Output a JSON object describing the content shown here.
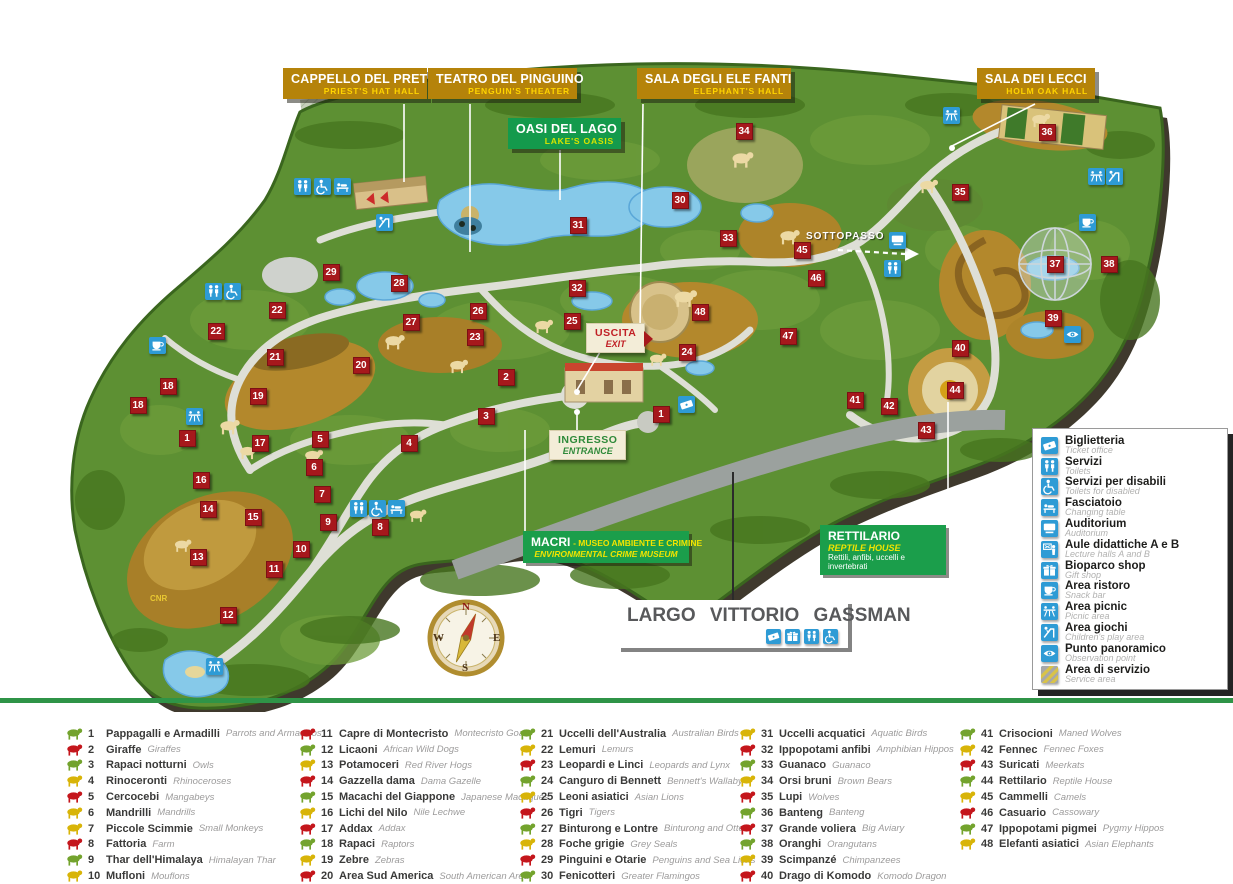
{
  "map": {
    "hall_labels": [
      {
        "id": "cappello-del-prete",
        "title": "CAPPELLO DEL PRETE",
        "subtitle": "PRIEST'S HAT HALL",
        "style": "gold",
        "x": 283,
        "y": 68,
        "w": 144
      },
      {
        "id": "teatro-del-pinguino",
        "title": "TEATRO DEL PINGUINO",
        "subtitle": "PENGUIN'S THEATER",
        "style": "gold",
        "x": 428,
        "y": 68,
        "w": 149
      },
      {
        "id": "oasi-del-lago",
        "title": "OASI DEL LAGO",
        "subtitle": "LAKE'S OASIS",
        "style": "green",
        "x": 508,
        "y": 118,
        "w": 113
      },
      {
        "id": "sala-degli-elefanti",
        "title": "SALA DEGLI ELE FANTI",
        "subtitle": "ELEPHANT'S HALL",
        "style": "gold",
        "x": 637,
        "y": 68,
        "w": 154
      },
      {
        "id": "sala-dei-lecci",
        "title": "SALA DEI LECCI",
        "subtitle": "HOLM OAK HALL",
        "style": "gold",
        "x": 977,
        "y": 68,
        "w": 118
      }
    ],
    "special": {
      "uscita": {
        "title": "USCITA",
        "subtitle": "EXIT"
      },
      "ingresso": {
        "title": "INGRESSO",
        "subtitle": "ENTRANCE"
      },
      "macri": {
        "title": "MACRI",
        "subtitle": "-  MUSEO AMBIENTE  E CRIMINE",
        "subtitle2": "ENVIRONMENTAL CRIME MUSEUM"
      },
      "rettilario": {
        "title": "RETTILARIO",
        "subtitle": "REPTILE HOUSE",
        "desc": "Rettili, anfibi, uccelli e invertebrati"
      },
      "largo": {
        "title": "LARGO VITTORIO GASSMAN",
        "icons": [
          "ticket",
          "shop",
          "toilets",
          "disabled"
        ]
      },
      "sottopasso": {
        "text": "SOTTOPASSO"
      },
      "cnr": {
        "text": "CNR"
      }
    },
    "compass": {
      "n": "N",
      "e": "E",
      "s": "S",
      "w": "W"
    },
    "markers": [
      {
        "n": "1",
        "x": 187,
        "y": 438
      },
      {
        "n": "16",
        "x": 201,
        "y": 480
      },
      {
        "n": "18",
        "x": 138,
        "y": 405
      },
      {
        "n": "18",
        "x": 168,
        "y": 386
      },
      {
        "n": "13",
        "x": 198,
        "y": 557
      },
      {
        "n": "14",
        "x": 208,
        "y": 509
      },
      {
        "n": "12",
        "x": 228,
        "y": 615
      },
      {
        "n": "15",
        "x": 253,
        "y": 517
      },
      {
        "n": "11",
        "x": 274,
        "y": 569
      },
      {
        "n": "10",
        "x": 301,
        "y": 549
      },
      {
        "n": "9",
        "x": 328,
        "y": 522
      },
      {
        "n": "8",
        "x": 380,
        "y": 527
      },
      {
        "n": "7",
        "x": 322,
        "y": 494
      },
      {
        "n": "6",
        "x": 314,
        "y": 467
      },
      {
        "n": "5",
        "x": 320,
        "y": 439
      },
      {
        "n": "17",
        "x": 260,
        "y": 443
      },
      {
        "n": "4",
        "x": 409,
        "y": 443
      },
      {
        "n": "19",
        "x": 258,
        "y": 396
      },
      {
        "n": "20",
        "x": 361,
        "y": 365
      },
      {
        "n": "21",
        "x": 275,
        "y": 357
      },
      {
        "n": "22",
        "x": 216,
        "y": 331
      },
      {
        "n": "22",
        "x": 277,
        "y": 310
      },
      {
        "n": "29",
        "x": 331,
        "y": 272
      },
      {
        "n": "28",
        "x": 399,
        "y": 283
      },
      {
        "n": "27",
        "x": 411,
        "y": 322
      },
      {
        "n": "26",
        "x": 478,
        "y": 311
      },
      {
        "n": "23",
        "x": 475,
        "y": 337
      },
      {
        "n": "25",
        "x": 572,
        "y": 321
      },
      {
        "n": "24",
        "x": 687,
        "y": 352
      },
      {
        "n": "2",
        "x": 506,
        "y": 377
      },
      {
        "n": "3",
        "x": 486,
        "y": 416
      },
      {
        "n": "1",
        "x": 661,
        "y": 414
      },
      {
        "n": "31",
        "x": 578,
        "y": 225
      },
      {
        "n": "32",
        "x": 577,
        "y": 288
      },
      {
        "n": "30",
        "x": 680,
        "y": 200
      },
      {
        "n": "34",
        "x": 744,
        "y": 131
      },
      {
        "n": "33",
        "x": 728,
        "y": 238
      },
      {
        "n": "45",
        "x": 802,
        "y": 250
      },
      {
        "n": "46",
        "x": 816,
        "y": 278
      },
      {
        "n": "48",
        "x": 700,
        "y": 312
      },
      {
        "n": "47",
        "x": 788,
        "y": 336
      },
      {
        "n": "35",
        "x": 960,
        "y": 192
      },
      {
        "n": "36",
        "x": 1047,
        "y": 132
      },
      {
        "n": "37",
        "x": 1055,
        "y": 264
      },
      {
        "n": "38",
        "x": 1109,
        "y": 264
      },
      {
        "n": "39",
        "x": 1053,
        "y": 318
      },
      {
        "n": "40",
        "x": 960,
        "y": 348
      },
      {
        "n": "44",
        "x": 955,
        "y": 390
      },
      {
        "n": "41",
        "x": 855,
        "y": 400
      },
      {
        "n": "42",
        "x": 889,
        "y": 406
      },
      {
        "n": "43",
        "x": 926,
        "y": 430
      }
    ],
    "facility_icons": [
      {
        "icon": "toilets",
        "x": 302,
        "y": 186
      },
      {
        "icon": "disabled",
        "x": 322,
        "y": 186
      },
      {
        "icon": "changing",
        "x": 342,
        "y": 186
      },
      {
        "icon": "playground",
        "x": 384,
        "y": 222
      },
      {
        "icon": "toilets",
        "x": 213,
        "y": 291
      },
      {
        "icon": "disabled",
        "x": 232,
        "y": 291
      },
      {
        "icon": "restaurant",
        "x": 157,
        "y": 345
      },
      {
        "icon": "picnic",
        "x": 194,
        "y": 416
      },
      {
        "icon": "toilets",
        "x": 358,
        "y": 508
      },
      {
        "icon": "disabled",
        "x": 377,
        "y": 508
      },
      {
        "icon": "changing",
        "x": 396,
        "y": 508
      },
      {
        "icon": "picnic",
        "x": 214,
        "y": 666
      },
      {
        "icon": "ticket",
        "x": 686,
        "y": 404
      },
      {
        "icon": "auditorium",
        "x": 897,
        "y": 240
      },
      {
        "icon": "toilets",
        "x": 892,
        "y": 268
      },
      {
        "icon": "picnic",
        "x": 951,
        "y": 115
      },
      {
        "icon": "picnic",
        "x": 1096,
        "y": 176
      },
      {
        "icon": "playground",
        "x": 1114,
        "y": 176
      },
      {
        "icon": "restaurant",
        "x": 1087,
        "y": 222
      },
      {
        "icon": "panoramic",
        "x": 1072,
        "y": 334
      }
    ]
  },
  "legend_panel": {
    "items": [
      {
        "icon": "ticket",
        "name": "Biglietteria",
        "en": "Ticket office"
      },
      {
        "icon": "toilets",
        "name": "Servizi",
        "en": "Toilets"
      },
      {
        "icon": "disabled",
        "name": "Servizi per disabili",
        "en": "Toilets for disabled"
      },
      {
        "icon": "changing",
        "name": "Fasciatoio",
        "en": "Changing table"
      },
      {
        "icon": "auditorium",
        "name": "Auditorium",
        "en": "Auditorium"
      },
      {
        "icon": "lecture",
        "name": "Aule didattiche A e B",
        "en": "Lecture halls A and B"
      },
      {
        "icon": "shop",
        "name": "Bioparco shop",
        "en": "Gift shop"
      },
      {
        "icon": "restaurant",
        "name": "Area ristoro",
        "en": "Snack bar"
      },
      {
        "icon": "picnic",
        "name": "Area picnic",
        "en": "Picnic area"
      },
      {
        "icon": "playground",
        "name": "Area giochi",
        "en": "Children's play area"
      },
      {
        "icon": "panoramic",
        "name": "Punto panoramico",
        "en": "Observation point"
      },
      {
        "icon": "service",
        "name": "Area di servizio",
        "en": "Service area"
      }
    ]
  },
  "animal_legend": {
    "palette": {
      "red": "#c4161c",
      "green": "#73a32d",
      "yellow": "#d8b408"
    },
    "col_x": [
      64,
      297,
      517,
      737,
      957
    ],
    "columns": [
      [
        {
          "n": "1",
          "it": "Pappagalli e Armadilli",
          "en": "Parrots and Armadillos",
          "c": "green"
        },
        {
          "n": "2",
          "it": "Giraffe",
          "en": "Giraffes",
          "c": "red"
        },
        {
          "n": "3",
          "it": "Rapaci notturni",
          "en": "Owls",
          "c": "green"
        },
        {
          "n": "4",
          "it": "Rinoceronti",
          "en": "Rhinoceroses",
          "c": "yellow"
        },
        {
          "n": "5",
          "it": "Cercocebi",
          "en": "Mangabeys",
          "c": "red"
        },
        {
          "n": "6",
          "it": "Mandrilli",
          "en": "Mandrills",
          "c": "yellow"
        },
        {
          "n": "7",
          "it": "Piccole Scimmie",
          "en": "Small Monkeys",
          "c": "yellow"
        },
        {
          "n": "8",
          "it": "Fattoria",
          "en": "Farm",
          "c": "red"
        },
        {
          "n": "9",
          "it": "Thar dell'Himalaya",
          "en": "Himalayan Thar",
          "c": "green"
        },
        {
          "n": "10",
          "it": "Mufloni",
          "en": "Mouflons",
          "c": "yellow"
        }
      ],
      [
        {
          "n": "11",
          "it": "Capre di Montecristo",
          "en": "Montecristo Goats",
          "c": "red"
        },
        {
          "n": "12",
          "it": "Licaoni",
          "en": "African Wild Dogs",
          "c": "green"
        },
        {
          "n": "13",
          "it": "Potamoceri",
          "en": "Red River Hogs",
          "c": "yellow"
        },
        {
          "n": "14",
          "it": "Gazzella dama",
          "en": "Dama Gazelle",
          "c": "red"
        },
        {
          "n": "15",
          "it": "Macachi del Giappone",
          "en": "Japanese Macaques",
          "c": "green"
        },
        {
          "n": "16",
          "it": "Lichi del Nilo",
          "en": "Nile Lechwe",
          "c": "yellow"
        },
        {
          "n": "17",
          "it": "Addax",
          "en": "Addax",
          "c": "red"
        },
        {
          "n": "18",
          "it": "Rapaci",
          "en": "Raptors",
          "c": "green"
        },
        {
          "n": "19",
          "it": "Zebre",
          "en": "Zebras",
          "c": "yellow"
        },
        {
          "n": "20",
          "it": "Area Sud America",
          "en": "South American Area",
          "c": "red"
        }
      ],
      [
        {
          "n": "21",
          "it": "Uccelli dell'Australia",
          "en": "Australian Birds",
          "c": "green"
        },
        {
          "n": "22",
          "it": "Lemuri",
          "en": "Lemurs",
          "c": "yellow"
        },
        {
          "n": "23",
          "it": "Leopardi e Linci",
          "en": "Leopards and Lynx",
          "c": "red"
        },
        {
          "n": "24",
          "it": "Canguro di Bennett",
          "en": "Bennett's Wallaby",
          "c": "green"
        },
        {
          "n": "25",
          "it": "Leoni asiatici",
          "en": "Asian Lions",
          "c": "yellow"
        },
        {
          "n": "26",
          "it": "Tigri",
          "en": "Tigers",
          "c": "red"
        },
        {
          "n": "27",
          "it": "Binturong e Lontre",
          "en": "Binturong and Otters",
          "c": "green"
        },
        {
          "n": "28",
          "it": "Foche grigie",
          "en": "Grey Seals",
          "c": "yellow"
        },
        {
          "n": "29",
          "it": "Pinguini e Otarie",
          "en": "Penguins and Sea Lions",
          "c": "red"
        },
        {
          "n": "30",
          "it": "Fenicotteri",
          "en": "Greater Flamingos",
          "c": "green"
        }
      ],
      [
        {
          "n": "31",
          "it": "Uccelli acquatici",
          "en": "Aquatic Birds",
          "c": "yellow"
        },
        {
          "n": "32",
          "it": "Ippopotami anfibi",
          "en": "Amphibian Hippos",
          "c": "red"
        },
        {
          "n": "33",
          "it": "Guanaco",
          "en": "Guanaco",
          "c": "green"
        },
        {
          "n": "34",
          "it": "Orsi bruni",
          "en": "Brown Bears",
          "c": "yellow"
        },
        {
          "n": "35",
          "it": "Lupi",
          "en": "Wolves",
          "c": "red"
        },
        {
          "n": "36",
          "it": "Banteng",
          "en": "Banteng",
          "c": "green"
        },
        {
          "n": "37",
          "it": "Grande voliera",
          "en": "Big Aviary",
          "c": "red"
        },
        {
          "n": "38",
          "it": "Oranghi",
          "en": "Orangutans",
          "c": "green"
        },
        {
          "n": "39",
          "it": "Scimpanzé",
          "en": "Chimpanzees",
          "c": "yellow"
        },
        {
          "n": "40",
          "it": "Drago di Komodo",
          "en": "Komodo Dragon",
          "c": "red"
        }
      ],
      [
        {
          "n": "41",
          "it": "Crisocioni",
          "en": "Maned Wolves",
          "c": "green"
        },
        {
          "n": "42",
          "it": "Fennec",
          "en": "Fennec Foxes",
          "c": "yellow"
        },
        {
          "n": "43",
          "it": "Suricati",
          "en": "Meerkats",
          "c": "red"
        },
        {
          "n": "44",
          "it": "Rettilario",
          "en": "Reptile House",
          "c": "green"
        },
        {
          "n": "45",
          "it": "Cammelli",
          "en": "Camels",
          "c": "yellow"
        },
        {
          "n": "46",
          "it": "Casuario",
          "en": "Cassowary",
          "c": "red"
        },
        {
          "n": "47",
          "it": "Ippopotami pigmei",
          "en": "Pygmy Hippos",
          "c": "green"
        },
        {
          "n": "48",
          "it": "Elefanti asiatici",
          "en": "Asian Elephants",
          "c": "yellow"
        }
      ]
    ]
  }
}
